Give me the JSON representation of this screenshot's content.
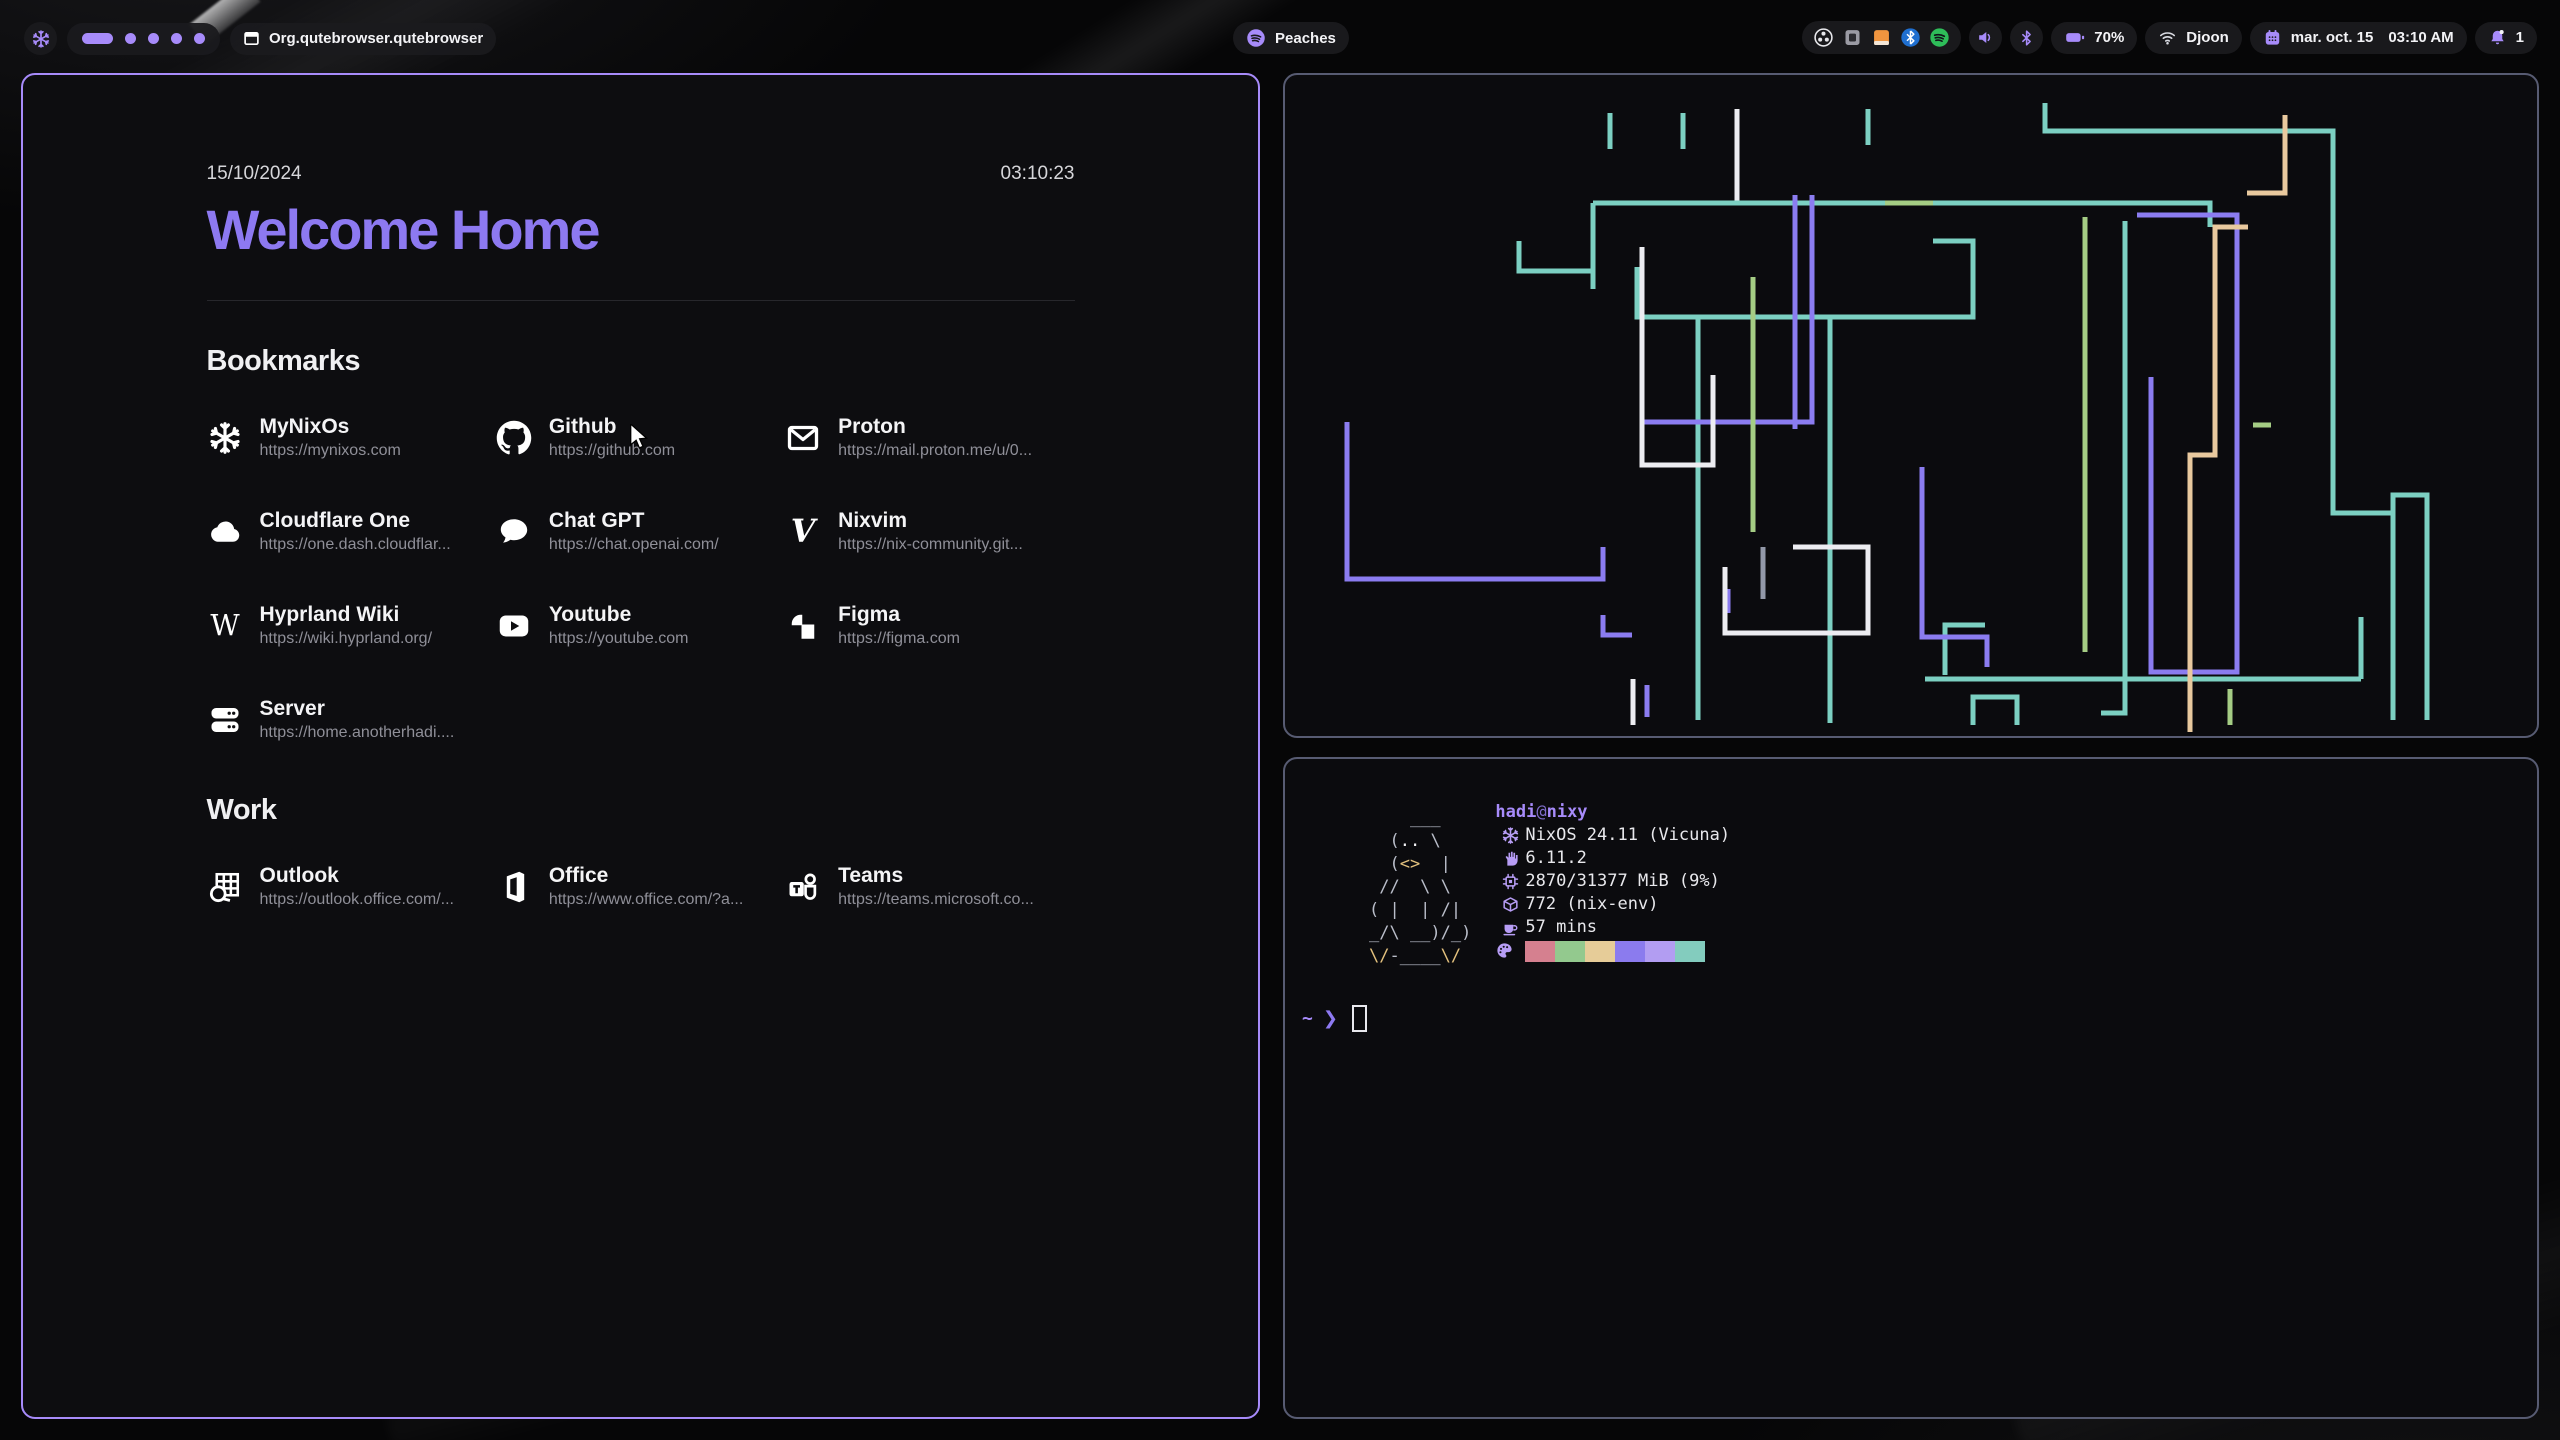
{
  "topbar": {
    "launcher_icon": "nixos",
    "workspaces": {
      "active_slot": 1,
      "slots": 5
    },
    "window_title": "Org.qutebrowser.qutebrowser",
    "media": {
      "label": "Peaches",
      "icon": "spotify"
    },
    "tray_icons": [
      "obs",
      "keepassxc",
      "files",
      "bluetooth-blue",
      "spotify-green"
    ],
    "battery": {
      "percent": "70%"
    },
    "network": {
      "name": "Djoon"
    },
    "clock": {
      "date": "mar. oct. 15",
      "time": "03:10 AM"
    },
    "notifications": {
      "count": "1"
    },
    "accent_color": "#a78bfa"
  },
  "startpage": {
    "date": "15/10/2024",
    "time": "03:10:23",
    "title": "Welcome Home",
    "title_color": "#8d79f1",
    "sections": [
      {
        "heading": "Bookmarks",
        "items": [
          {
            "name": "MyNixOs",
            "url": "https://mynixos.com",
            "icon": "nixos"
          },
          {
            "name": "Github",
            "url": "https://github.com",
            "icon": "github"
          },
          {
            "name": "Proton",
            "url": "https://mail.proton.me/u/0...",
            "icon": "mail"
          },
          {
            "name": "Cloudflare One",
            "url": "https://one.dash.cloudflar...",
            "icon": "cloud"
          },
          {
            "name": "Chat GPT",
            "url": "https://chat.openai.com/",
            "icon": "chat"
          },
          {
            "name": "Nixvim",
            "url": "https://nix-community.git...",
            "icon": "vim"
          },
          {
            "name": "Hyprland Wiki",
            "url": "https://wiki.hyprland.org/",
            "icon": "wikipedia"
          },
          {
            "name": "Youtube",
            "url": "https://youtube.com",
            "icon": "youtube"
          },
          {
            "name": "Figma",
            "url": "https://figma.com",
            "icon": "figma"
          },
          {
            "name": "Server",
            "url": "https://home.anotherhadi....",
            "icon": "server"
          }
        ]
      },
      {
        "heading": "Work",
        "items": [
          {
            "name": "Outlook",
            "url": "https://outlook.office.com/...",
            "icon": "outlook"
          },
          {
            "name": "Office",
            "url": "https://www.office.com/?a...",
            "icon": "office"
          },
          {
            "name": "Teams",
            "url": "https://teams.microsoft.co...",
            "icon": "teams"
          }
        ]
      }
    ]
  },
  "fetch": {
    "user": "hadi",
    "at": "@",
    "host": "nixy",
    "rows": [
      {
        "icon": "nix",
        "text": "NixOS 24.11 (Vicuna)"
      },
      {
        "icon": "kernel",
        "text": "6.11.2"
      },
      {
        "icon": "memory",
        "text": "2870/31377 MiB (9%)"
      },
      {
        "icon": "packages",
        "text": "772 (nix-env)"
      },
      {
        "icon": "uptime",
        "text": "57 mins"
      }
    ],
    "palette": [
      "#d5808f",
      "#93c98e",
      "#e6cc98",
      "#8b7bee",
      "#b29df2",
      "#83ccbe"
    ],
    "art": [
      [
        {
          "t": "    ___   ",
          "c": "fg"
        }
      ],
      [
        {
          "t": "  (",
          "c": "fg"
        },
        {
          "t": "..",
          "c": "hi"
        },
        {
          "t": " \\   ",
          "c": "fg"
        }
      ],
      [
        {
          "t": "  (",
          "c": "fg"
        },
        {
          "t": "<>",
          "c": "yl"
        },
        {
          "t": "  |  ",
          "c": "fg"
        }
      ],
      [
        {
          "t": " //  \\ \\  ",
          "c": "fg"
        }
      ],
      [
        {
          "t": "( |  | /| ",
          "c": "fg"
        }
      ],
      [
        {
          "t": "_/\\ __)/_)",
          "c": "fg"
        }
      ],
      [
        {
          "t": "\\/",
          "c": "yl"
        },
        {
          "t": "-____",
          "c": "fg"
        },
        {
          "t": "\\/",
          "c": "yl"
        }
      ]
    ],
    "prompt": {
      "tilde": "~",
      "arrow": "❯"
    }
  },
  "pipes": {
    "colors": {
      "t": "#7cd0c2",
      "p": "#8b7cf0",
      "g": "#a5cd84",
      "s": "#e9c99e",
      "w": "#ededf1",
      "r": "#9298a8"
    },
    "lines": [
      {
        "c": "t",
        "p": [
          [
            325,
            38
          ],
          [
            325,
            74
          ]
        ]
      },
      {
        "c": "t",
        "p": [
          [
            398,
            38
          ],
          [
            398,
            74
          ]
        ]
      },
      {
        "c": "t",
        "p": [
          [
            583,
            34
          ],
          [
            583,
            70
          ]
        ]
      },
      {
        "c": "w",
        "p": [
          [
            452,
            34
          ],
          [
            452,
            130
          ]
        ]
      },
      {
        "c": "t",
        "p": [
          [
            308,
            128
          ],
          [
            925,
            128
          ],
          [
            925,
            152
          ]
        ]
      },
      {
        "c": "t",
        "p": [
          [
            308,
            128
          ],
          [
            308,
            214
          ]
        ]
      },
      {
        "c": "t",
        "p": [
          [
            234,
            166
          ],
          [
            234,
            196
          ],
          [
            308,
            196
          ]
        ]
      },
      {
        "c": "t",
        "p": [
          [
            352,
            192
          ],
          [
            352,
            242
          ],
          [
            688,
            242
          ],
          [
            688,
            166
          ],
          [
            648,
            166
          ]
        ]
      },
      {
        "c": "t",
        "p": [
          [
            413,
            242
          ],
          [
            413,
            645
          ]
        ]
      },
      {
        "c": "t",
        "p": [
          [
            760,
            28
          ],
          [
            760,
            56
          ],
          [
            1048,
            56
          ],
          [
            1048,
            438
          ],
          [
            1108,
            438
          ]
        ]
      },
      {
        "c": "t",
        "p": [
          [
            840,
            146
          ],
          [
            840,
            638
          ],
          [
            816,
            638
          ]
        ]
      },
      {
        "c": "t",
        "p": [
          [
            660,
            600
          ],
          [
            660,
            550
          ],
          [
            700,
            550
          ]
        ]
      },
      {
        "c": "t",
        "p": [
          [
            640,
            604
          ],
          [
            1076,
            604
          ]
        ]
      },
      {
        "c": "t",
        "p": [
          [
            1076,
            604
          ],
          [
            1076,
            542
          ]
        ]
      },
      {
        "c": "t",
        "p": [
          [
            1108,
            645
          ],
          [
            1108,
            420
          ],
          [
            1142,
            420
          ],
          [
            1142,
            645
          ]
        ]
      },
      {
        "c": "t",
        "p": [
          [
            688,
            650
          ],
          [
            688,
            622
          ],
          [
            732,
            622
          ],
          [
            732,
            650
          ]
        ]
      },
      {
        "c": "t",
        "p": [
          [
            545,
            244
          ],
          [
            545,
            648
          ]
        ]
      },
      {
        "c": "p",
        "p": [
          [
            510,
            120
          ],
          [
            510,
            354
          ]
        ]
      },
      {
        "c": "p",
        "p": [
          [
            527,
            120
          ],
          [
            527,
            347
          ],
          [
            357,
            347
          ]
        ]
      },
      {
        "c": "p",
        "p": [
          [
            62,
            347
          ],
          [
            62,
            504
          ],
          [
            318,
            504
          ],
          [
            318,
            472
          ]
        ]
      },
      {
        "c": "p",
        "p": [
          [
            637,
            392
          ],
          [
            637,
            562
          ],
          [
            702,
            562
          ],
          [
            702,
            592
          ]
        ]
      },
      {
        "c": "p",
        "p": [
          [
            852,
            140
          ],
          [
            952,
            140
          ],
          [
            952,
            597
          ],
          [
            866,
            597
          ],
          [
            866,
            302
          ]
        ]
      },
      {
        "c": "p",
        "p": [
          [
            362,
            642
          ],
          [
            362,
            610
          ]
        ]
      },
      {
        "c": "p",
        "p": [
          [
            443,
            514
          ],
          [
            443,
            538
          ]
        ]
      },
      {
        "c": "p",
        "p": [
          [
            347,
            560
          ],
          [
            318,
            560
          ],
          [
            318,
            540
          ]
        ]
      },
      {
        "c": "g",
        "p": [
          [
            468,
            202
          ],
          [
            468,
            457
          ]
        ]
      },
      {
        "c": "g",
        "p": [
          [
            800,
            142
          ],
          [
            800,
            577
          ]
        ]
      },
      {
        "c": "g",
        "p": [
          [
            968,
            350
          ],
          [
            986,
            350
          ]
        ]
      },
      {
        "c": "g",
        "p": [
          [
            945,
            650
          ],
          [
            945,
            614
          ]
        ]
      },
      {
        "c": "g",
        "p": [
          [
            600,
            128
          ],
          [
            648,
            128
          ]
        ]
      },
      {
        "c": "s",
        "p": [
          [
            1000,
            40
          ],
          [
            1000,
            118
          ],
          [
            962,
            118
          ]
        ]
      },
      {
        "c": "s",
        "p": [
          [
            905,
            657
          ],
          [
            905,
            380
          ],
          [
            930,
            380
          ],
          [
            930,
            152
          ],
          [
            963,
            152
          ]
        ]
      },
      {
        "c": "w",
        "p": [
          [
            357,
            172
          ],
          [
            357,
            390
          ],
          [
            428,
            390
          ],
          [
            428,
            300
          ]
        ]
      },
      {
        "c": "w",
        "p": [
          [
            440,
            492
          ],
          [
            440,
            558
          ],
          [
            583,
            558
          ],
          [
            583,
            472
          ],
          [
            508,
            472
          ]
        ]
      },
      {
        "c": "w",
        "p": [
          [
            348,
            650
          ],
          [
            348,
            604
          ]
        ]
      },
      {
        "c": "r",
        "p": [
          [
            478,
            472
          ],
          [
            478,
            524
          ]
        ]
      }
    ]
  }
}
